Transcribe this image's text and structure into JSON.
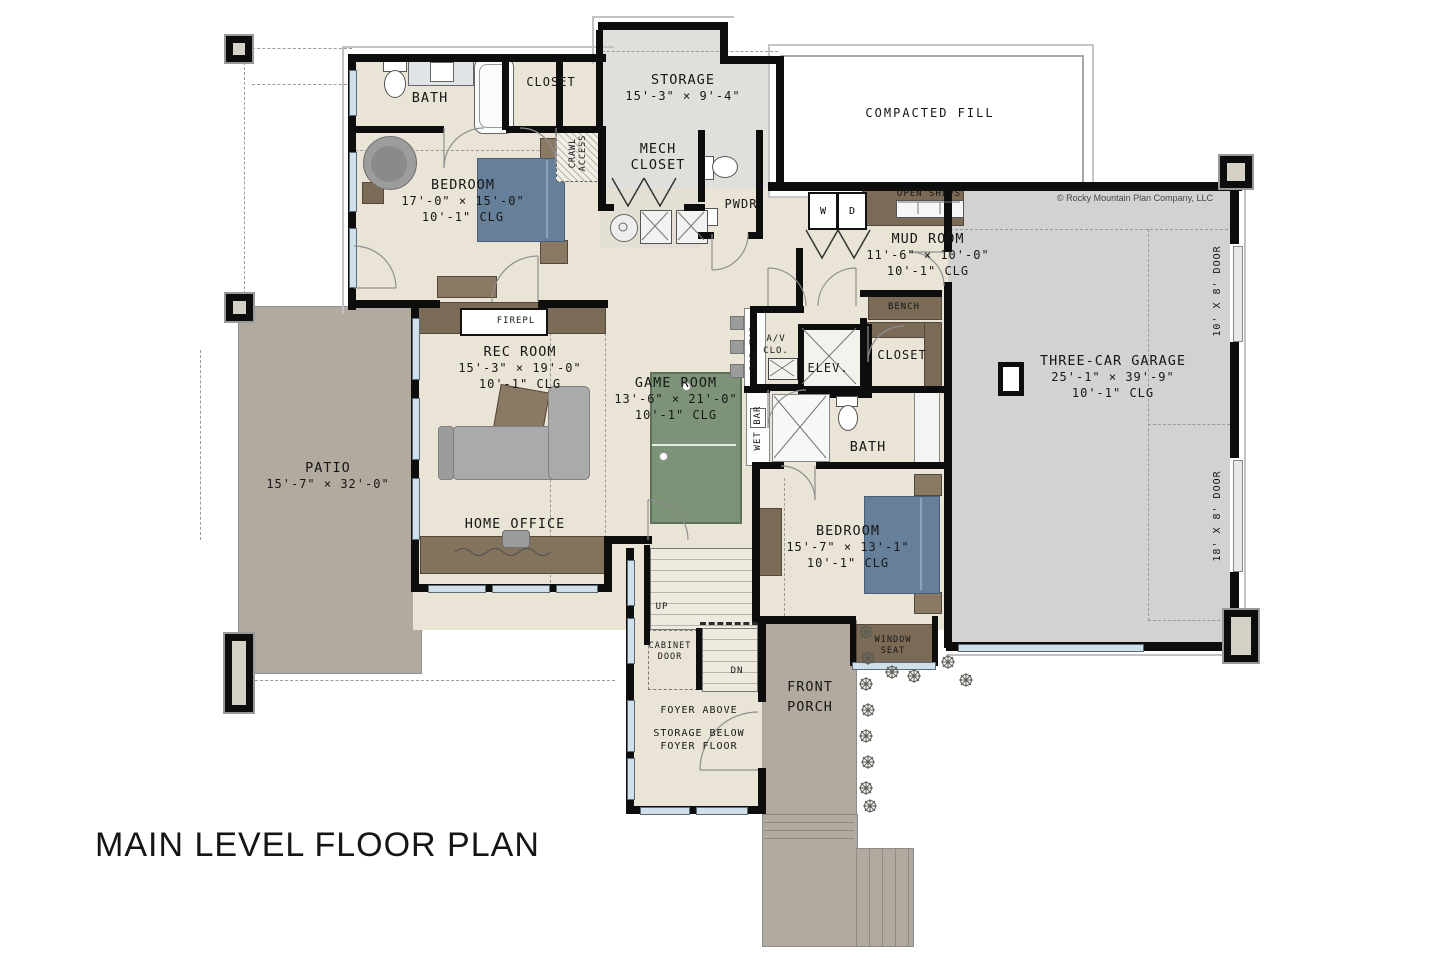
{
  "title": "MAIN LEVEL FLOOR PLAN",
  "copyright": "© Rocky Mountain Plan Company, LLC",
  "colors": {
    "wall": "#0d0d0d",
    "floor_main": "#eae4d6",
    "floor_storage": "#dfdfdc",
    "floor_garage": "#d2d2d0",
    "patio_porch": "#b2aa9e",
    "cabinet_brown": "#7a6a56",
    "bed_blue": "#67809a",
    "game_table_green": "#7d9377",
    "sofa_gray": "#aaaaaa",
    "window_glass": "#cfe0ea",
    "compacted_fill_bg": "#ffffff"
  },
  "labels": {
    "bath1": "BATH",
    "closet1": "CLOSET",
    "storage_name": "STORAGE",
    "storage_dims": "15'-3\" × 9'-4\"",
    "compacted_fill": "COMPACTED FILL",
    "bedroom1_name": "BEDROOM",
    "bedroom1_dims": "17'-0\" × 15'-0\"",
    "bedroom1_clg": "10'-1\" CLG",
    "crawl_line1": "CRAWL",
    "crawl_line2": "ACCESS",
    "mech_line1": "MECH",
    "mech_line2": "CLOSET",
    "pwdr": "PWDR",
    "washer": "W",
    "dryer": "D",
    "open_shlvs": "OPEN SHLVS",
    "mudroom_name": "MUD ROOM",
    "mudroom_dims": "11'-6\" × 10'-0\"",
    "mudroom_clg": "10'-1\" CLG",
    "bench": "BENCH",
    "garage_name": "THREE-CAR GARAGE",
    "garage_dims": "25'-1\" × 39'-9\"",
    "garage_clg": "10'-1\" CLG",
    "garage_door_small": "10' X 8' DOOR",
    "garage_door_large": "18' X 8' DOOR",
    "firepl": "FIREPL",
    "rec_name": "REC ROOM",
    "rec_dims": "15'-3\" × 19'-0\"",
    "rec_clg": "10'-1\" CLG",
    "game_name": "GAME ROOM",
    "game_dims": "13'-6\" × 21'-0\"",
    "game_clg": "10'-1\" CLG",
    "bar_top": "BAR TOP",
    "av_line1": "A/V",
    "av_line2": "CLO.",
    "elev": "ELEV.",
    "closet2": "CLOSET",
    "wet_bar": "WET BAR",
    "bath2": "BATH",
    "patio_name": "PATIO",
    "patio_dims": "15'-7\" × 32'-0\"",
    "home_office": "HOME OFFICE",
    "bedroom2_name": "BEDROOM",
    "bedroom2_dims": "15'-7\" × 13'-1\"",
    "bedroom2_clg": "10'-1\" CLG",
    "window_seat_line1": "WINDOW",
    "window_seat_line2": "SEAT",
    "up": "UP",
    "dn": "DN",
    "cabinet_door_line1": "CABINET",
    "cabinet_door_line2": "DOOR",
    "foyer_above": "FOYER ABOVE",
    "storage_below_line1": "STORAGE BELOW",
    "storage_below_line2": "FOYER FLOOR",
    "porch_line1": "FRONT",
    "porch_line2": "PORCH"
  }
}
